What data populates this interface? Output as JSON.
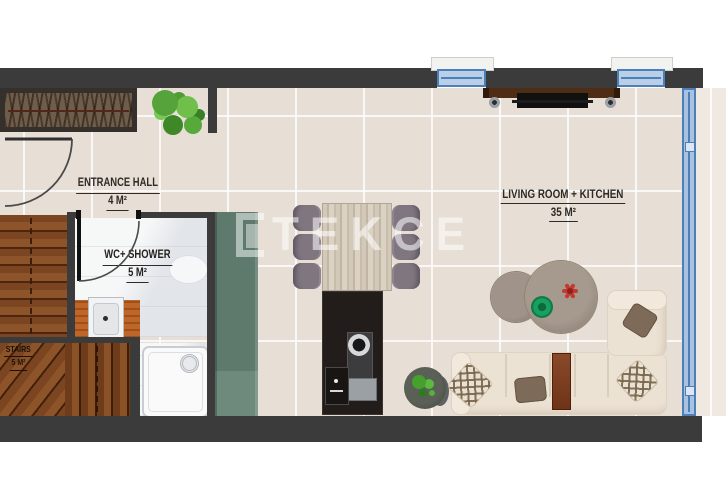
{
  "watermark": {
    "text": "TEKCE"
  },
  "rooms": {
    "entrance_hall": {
      "name": "ENTRANCE HALL",
      "area": "4 M²"
    },
    "wc_shower": {
      "name": "WC+ SHOWER",
      "area": "5 M²"
    },
    "stairs": {
      "name": "STAIRS",
      "area": "5 M²"
    },
    "living_kitchen": {
      "name": "LIVING ROOM + KITCHEN",
      "area": "35 M²"
    }
  },
  "icons": {
    "wardrobe": "hanger-rail",
    "entrance_plant": "potted-plant",
    "kitchen_plant": "potted-plant",
    "dining_set": "table-with-6-chairs",
    "kitchen_island": "counter-sink-stove",
    "tv": "wall-mounted-tv-unit",
    "sofa": "l-shaped-sectional-sofa",
    "coffee_tables": "round-nesting-tables",
    "shower": "shower-tray-with-drain",
    "washbasin": "countertop-sink",
    "toilet": "wc-pan",
    "windows": "blue-window-frames",
    "doors": "swing-door-arcs",
    "stairs": "wooden-winder-stairs"
  },
  "colors": {
    "wall": "#3b3b3b",
    "floor_tile": "#e7ded5",
    "wc_floor": "#eef0f2",
    "stairs_wood": "#74431f",
    "cabinet_green": "#5d7a6d",
    "island_black": "#221d1a",
    "window_blue": "#4d7fb8",
    "sofa_cream": "#ece2d4",
    "counter_orange": "#bf6527",
    "plant_green": "#55a33a"
  }
}
